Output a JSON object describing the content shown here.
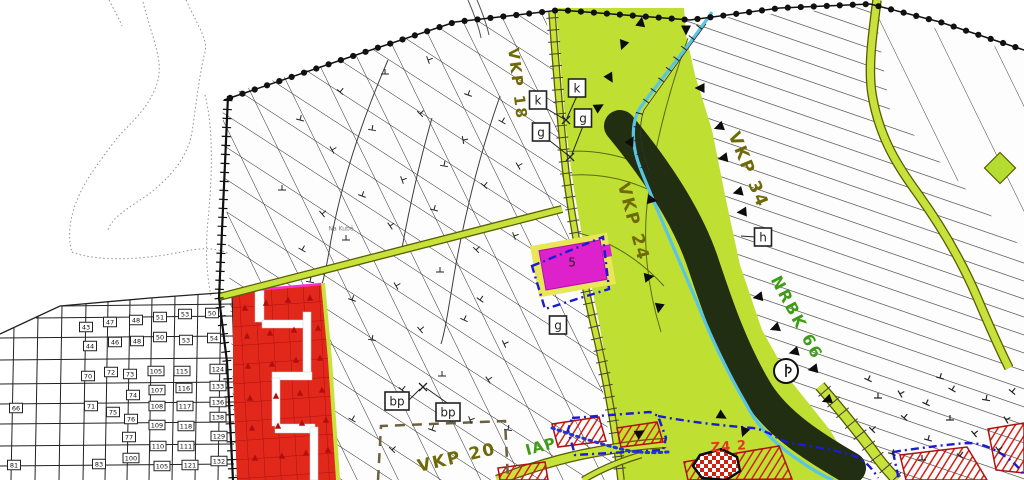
{
  "canvas": {
    "w": 1024,
    "h": 480
  },
  "palette": {
    "paper": "#ffffff",
    "hatch_dark": "#2f2f2f",
    "corridor_green": "#bfdf33",
    "forest_dark": "#212e12",
    "stream_blue": "#59c4e4",
    "road_fill": "#c7e23a",
    "road_edge": "#5c5c00",
    "red_zone": "#e2271b",
    "red_zone_line": "#aa1111",
    "red_hatch": "#d41f14",
    "magenta": "#dd22cc",
    "magenta_buffer": "#e9e659",
    "blue_boundary": "#1b1bd4",
    "olive_label": "#6f6a08",
    "green_label": "#3f9d15",
    "boundary_black": "#111111"
  },
  "regions": {
    "central_hatch": {
      "points": [
        [
          222,
          96
        ],
        [
          350,
          57
        ],
        [
          455,
          22
        ],
        [
          545,
          10
        ],
        [
          552,
          60
        ],
        [
          558,
          130
        ],
        [
          566,
          190
        ],
        [
          578,
          258
        ],
        [
          592,
          328
        ],
        [
          604,
          398
        ],
        [
          614,
          480
        ],
        [
          235,
          480
        ],
        [
          230,
          295
        ]
      ],
      "hatches": [
        {
          "angle": 33,
          "gap": 27,
          "color": "#2f2f2f",
          "w": 1
        },
        {
          "angle": 64,
          "gap": 37,
          "color": "#2f2f2f",
          "w": 1
        }
      ]
    },
    "right_hatch": {
      "points": [
        [
          685,
          8
        ],
        [
          695,
          75
        ],
        [
          712,
          130
        ],
        [
          726,
          200
        ],
        [
          740,
          265
        ],
        [
          762,
          330
        ],
        [
          790,
          380
        ],
        [
          830,
          430
        ],
        [
          860,
          480
        ],
        [
          1024,
          480
        ],
        [
          1024,
          52
        ],
        [
          885,
          5
        ],
        [
          800,
          12
        ],
        [
          690,
          20
        ]
      ],
      "hatches": [
        {
          "angle": 19,
          "gap": 17,
          "color": "#383838",
          "w": 1.2
        }
      ]
    },
    "topright_cross": {
      "points": [
        [
          875,
          10
        ],
        [
          1024,
          55
        ],
        [
          1024,
          250
        ],
        [
          890,
          110
        ]
      ],
      "hatches": [
        {
          "angle": 64,
          "gap": 46,
          "color": "#444444",
          "w": 1
        }
      ]
    },
    "green_corridor": {
      "points": [
        [
          556,
          8
        ],
        [
          560,
          60
        ],
        [
          566,
          130
        ],
        [
          574,
          190
        ],
        [
          586,
          258
        ],
        [
          600,
          328
        ],
        [
          612,
          398
        ],
        [
          622,
          480
        ],
        [
          860,
          480
        ],
        [
          830,
          430
        ],
        [
          790,
          380
        ],
        [
          762,
          330
        ],
        [
          740,
          265
        ],
        [
          726,
          200
        ],
        [
          712,
          130
        ],
        [
          695,
          75
        ],
        [
          686,
          35
        ],
        [
          684,
          8
        ]
      ]
    }
  },
  "forest": {
    "d": "M620,126 C658,172 688,218 703,263 C718,308 733,352 758,393 C778,424 812,446 850,468",
    "width": 32
  },
  "stream": {
    "d": "M712,12 C692,42 662,78 640,108 C630,124 632,148 641,170 C656,208 676,253 696,300 C710,335 726,370 746,404 C757,426 776,445 800,461 C813,470 823,476 833,480",
    "width": 3.2
  },
  "roads": [
    {
      "d": "M219,297 L562,209",
      "w": 5.5
    },
    {
      "d": "M552,12 C556,68 560,118 566,173 C574,233 586,293 598,343 C608,389 616,434 621,480",
      "w": 5,
      "ticks": 12
    },
    {
      "d": "M877,0 C872,38 868,68 872,94 C879,138 899,168 918,194 C941,226 962,262 977,297 C991,330 1001,352 1009,368",
      "w": 7
    },
    {
      "d": "M820,386 C844,414 864,439 877,457 C886,469 892,475 897,480",
      "w": 9,
      "ticks": 14
    },
    {
      "d": "M497,480 C530,468 561,458 595,452 C621,447 646,444 666,443",
      "w": 8
    },
    {
      "d": "M583,480 C601,469 621,461 641,455",
      "w": 4.5
    }
  ],
  "boundary_dots": {
    "points": [
      [
        224,
        100
      ],
      [
        350,
        57
      ],
      [
        455,
        22
      ],
      [
        560,
        10
      ],
      [
        690,
        20
      ],
      [
        780,
        8
      ],
      [
        870,
        4
      ],
      [
        940,
        22
      ],
      [
        1024,
        50
      ]
    ],
    "r": 3.1,
    "step": 13
  },
  "ladder": {
    "points": [
      [
        228,
        96
      ],
      [
        219,
        298
      ],
      [
        227,
        362
      ],
      [
        233,
        480
      ]
    ],
    "step": 9,
    "tick": 9
  },
  "field_path": [
    "M468,0 C474,14 479,27 481,38",
    "M477,0 C483,14 487,26 489,35"
  ],
  "contours_faint": [
    "M143,2 C152,38 163,58 158,80 C150,110 126,126 114,142 C99,162 84,182 78,198 C70,216 67,236 72,252",
    "M186,0 C199,28 208,40 205,52 C199,76 196,106 192,132 C187,162 164,182 149,194 C130,207 112,217 108,230",
    "M109,0 C114,10 119,18 122,26",
    "M72,252 C100,263 150,259 186,251 C210,246 225,250 233,257",
    "M205,95 C214,130 212,180 208,220 C205,252 207,276 211,296"
  ],
  "contours_dark": [
    "M388,60 C362,120 342,180 331,240 C324,284 318,300 312,308",
    "M500,96 C481,150 466,210 456,264 C449,304 446,328 441,344",
    "M432,118 C420,160 410,205 402,248"
  ],
  "corridor_lines": [
    "M688,38 C670,88 656,140 649,190 C641,240 648,290 661,332",
    "M560,152 C600,148 638,158 676,182",
    "M562,176 C610,170 650,186 688,212",
    "M574,232 C610,240 640,260 664,286"
  ],
  "fence_line": {
    "d": "M706,24 C688,48 664,82 644,110 C638,126 640,148 649,170",
    "step": 13,
    "tick": 7
  },
  "grid": {
    "cols": [
      14,
      38,
      62,
      86,
      108,
      130,
      152,
      175,
      198,
      221
    ],
    "rows": [
      306,
      318,
      338,
      360,
      384,
      404,
      424,
      446,
      466
    ],
    "top": [
      [
        0,
        334
      ],
      [
        60,
        306
      ],
      [
        150,
        298
      ],
      [
        232,
        292
      ]
    ],
    "right": [
      [
        232,
        292
      ],
      [
        238,
        480
      ]
    ]
  },
  "parcel_numbers": [
    {
      "n": "43",
      "x": 86,
      "y": 327
    },
    {
      "n": "47",
      "x": 110,
      "y": 322
    },
    {
      "n": "48",
      "x": 136,
      "y": 320
    },
    {
      "n": "51",
      "x": 160,
      "y": 317
    },
    {
      "n": "53",
      "x": 185,
      "y": 314
    },
    {
      "n": "50",
      "x": 212,
      "y": 313
    },
    {
      "n": "44",
      "x": 90,
      "y": 346
    },
    {
      "n": "46",
      "x": 115,
      "y": 342
    },
    {
      "n": "48",
      "x": 137,
      "y": 341
    },
    {
      "n": "50",
      "x": 160,
      "y": 337
    },
    {
      "n": "53",
      "x": 186,
      "y": 340
    },
    {
      "n": "54",
      "x": 214,
      "y": 338
    },
    {
      "n": "70",
      "x": 88,
      "y": 376
    },
    {
      "n": "72",
      "x": 111,
      "y": 372
    },
    {
      "n": "73",
      "x": 130,
      "y": 374
    },
    {
      "n": "105",
      "x": 156,
      "y": 371
    },
    {
      "n": "115",
      "x": 182,
      "y": 371
    },
    {
      "n": "124",
      "x": 218,
      "y": 369
    },
    {
      "n": "71",
      "x": 91,
      "y": 406
    },
    {
      "n": "74",
      "x": 133,
      "y": 395
    },
    {
      "n": "107",
      "x": 157,
      "y": 390
    },
    {
      "n": "116",
      "x": 184,
      "y": 388
    },
    {
      "n": "133",
      "x": 218,
      "y": 386
    },
    {
      "n": "75",
      "x": 113,
      "y": 412
    },
    {
      "n": "76",
      "x": 131,
      "y": 419
    },
    {
      "n": "108",
      "x": 157,
      "y": 406
    },
    {
      "n": "117",
      "x": 185,
      "y": 406
    },
    {
      "n": "136",
      "x": 218,
      "y": 402
    },
    {
      "n": "77",
      "x": 129,
      "y": 437
    },
    {
      "n": "109",
      "x": 157,
      "y": 425
    },
    {
      "n": "118",
      "x": 186,
      "y": 426
    },
    {
      "n": "138",
      "x": 218,
      "y": 417
    },
    {
      "n": "110",
      "x": 158,
      "y": 446
    },
    {
      "n": "111",
      "x": 186,
      "y": 446
    },
    {
      "n": "129",
      "x": 219,
      "y": 436
    },
    {
      "n": "83",
      "x": 99,
      "y": 464
    },
    {
      "n": "100",
      "x": 131,
      "y": 458
    },
    {
      "n": "105",
      "x": 162,
      "y": 466
    },
    {
      "n": "121",
      "x": 190,
      "y": 465
    },
    {
      "n": "132",
      "x": 219,
      "y": 461
    },
    {
      "n": "66",
      "x": 16,
      "y": 408
    },
    {
      "n": "81",
      "x": 14,
      "y": 465
    }
  ],
  "red_zone": {
    "points": [
      [
        233,
        291
      ],
      [
        322,
        283
      ],
      [
        330,
        360
      ],
      [
        337,
        480
      ],
      [
        237,
        480
      ],
      [
        233,
        380
      ]
    ],
    "streets": [
      [
        255,
        288,
        9,
        34
      ],
      [
        262,
        320,
        46,
        8
      ],
      [
        303,
        312,
        8,
        62
      ],
      [
        272,
        372,
        40,
        8
      ],
      [
        272,
        378,
        8,
        48
      ],
      [
        275,
        424,
        40,
        9
      ],
      [
        310,
        427,
        8,
        53
      ]
    ],
    "triangles": [
      [
        245,
        308
      ],
      [
        266,
        303
      ],
      [
        288,
        300
      ],
      [
        310,
        298
      ],
      [
        247,
        336
      ],
      [
        270,
        333
      ],
      [
        294,
        330
      ],
      [
        318,
        328
      ],
      [
        248,
        366
      ],
      [
        272,
        364
      ],
      [
        296,
        360
      ],
      [
        320,
        358
      ],
      [
        250,
        398
      ],
      [
        276,
        396
      ],
      [
        300,
        393
      ],
      [
        322,
        390
      ],
      [
        252,
        428
      ],
      [
        278,
        426
      ],
      [
        302,
        423
      ],
      [
        326,
        420
      ],
      [
        255,
        458
      ],
      [
        282,
        456
      ],
      [
        306,
        453
      ],
      [
        328,
        450
      ]
    ],
    "pink_edge": "M231,292 L322,284",
    "lime_edge": "M323,283 L330,360 L338,480"
  },
  "red_hatch_shapes": [
    [
      [
        552,
        424
      ],
      [
        599,
        417
      ],
      [
        606,
        441
      ],
      [
        558,
        447
      ]
    ],
    [
      [
        617,
        428
      ],
      [
        657,
        422
      ],
      [
        663,
        442
      ],
      [
        621,
        447
      ]
    ],
    [
      [
        684,
        462
      ],
      [
        779,
        446
      ],
      [
        792,
        479
      ],
      [
        688,
        480
      ]
    ],
    [
      [
        900,
        455
      ],
      [
        967,
        447
      ],
      [
        987,
        480
      ],
      [
        906,
        480
      ]
    ],
    [
      [
        988,
        429
      ],
      [
        1024,
        423
      ],
      [
        1024,
        473
      ],
      [
        996,
        470
      ]
    ],
    [
      [
        498,
        468
      ],
      [
        545,
        462
      ],
      [
        548,
        480
      ],
      [
        500,
        480
      ]
    ]
  ],
  "checker_blob": [
    [
      700,
      455
    ],
    [
      722,
      449
    ],
    [
      737,
      457
    ],
    [
      740,
      471
    ],
    [
      726,
      480
    ],
    [
      702,
      478
    ],
    [
      693,
      466
    ]
  ],
  "magenta_parcel": {
    "cx": 573,
    "cy": 265,
    "rot": -10,
    "outer": [
      78,
      52
    ],
    "inner": [
      62,
      40
    ],
    "label": "5"
  },
  "blue_dashdot": [
    "M532,266 L603,237 L609,289 L545,309 Z",
    "M572,418 L650,412 L658,416 L666,438 L663,450 L575,455 L568,430 Z",
    "M658,416 C700,424 740,427 753,428 C770,431 778,440 790,443 C810,446 835,450 852,455 C865,460 872,468 878,478",
    "M893,452 C920,448 950,444 968,443 C985,443 1000,452 1010,460 C1018,466 1022,472 1024,476",
    "M893,452 L899,480"
  ],
  "blue_dotted": "M552,428 C575,436 600,444 625,450 C640,453 655,453 668,452",
  "vkp20_rect": "M378,480 L381,426 L505,421 L508,480",
  "green_diamond": {
    "x": 1000,
    "y": 168,
    "s": 22
  },
  "circle_symbol": {
    "x": 786,
    "y": 371,
    "r": 12
  },
  "labels": [
    {
      "id": "vkp-18",
      "text": "VKP 18",
      "x": 517,
      "y": 84,
      "rot": 83,
      "size": 15,
      "color": "#6f6a08",
      "ls": 2,
      "bold": true
    },
    {
      "id": "vkp-24",
      "text": "VKP 24",
      "x": 633,
      "y": 222,
      "rot": 75,
      "size": 17,
      "color": "#6f6a08",
      "ls": 2,
      "bold": true
    },
    {
      "id": "vkp-34",
      "text": "VKP 34",
      "x": 748,
      "y": 170,
      "rot": 68,
      "size": 17,
      "color": "#6f6a08",
      "ls": 2,
      "bold": true
    },
    {
      "id": "nrbk-66",
      "text": "NRBK 66",
      "x": 796,
      "y": 318,
      "rot": 62,
      "size": 16,
      "color": "#3f9d15",
      "ls": 2,
      "bold": true
    },
    {
      "id": "vkp-20",
      "text": "VKP 20",
      "x": 457,
      "y": 458,
      "rot": -13,
      "size": 17,
      "color": "#6f6a08",
      "ls": 2,
      "bold": true
    },
    {
      "id": "iap",
      "text": "IAP",
      "x": 541,
      "y": 447,
      "rot": -15,
      "size": 15,
      "color": "#3f9d15",
      "ls": 1,
      "bold": true
    },
    {
      "id": "z4-2",
      "text": "Z4 2",
      "x": 729,
      "y": 447,
      "rot": -4,
      "size": 13,
      "color": "#e83522",
      "ls": 1,
      "bold": true
    },
    {
      "id": "parcel-5",
      "text": "5",
      "x": 572,
      "y": 263,
      "rot": 0,
      "size": 12,
      "color": "#222222",
      "ls": 0,
      "bold": false
    },
    {
      "id": "na-kube",
      "text": "Na Kubě",
      "x": 341,
      "y": 229,
      "rot": 0,
      "size": 6,
      "color": "#777777",
      "ls": 0,
      "bold": false
    }
  ],
  "boxed_labels": [
    {
      "t": "k",
      "x": 577,
      "y": 88
    },
    {
      "t": "k",
      "x": 538,
      "y": 100
    },
    {
      "t": "g",
      "x": 583,
      "y": 118
    },
    {
      "t": "g",
      "x": 541,
      "y": 132
    },
    {
      "t": "g",
      "x": 558,
      "y": 325
    },
    {
      "t": "h",
      "x": 763,
      "y": 237
    },
    {
      "t": "bp",
      "x": 397,
      "y": 401
    },
    {
      "t": "bp",
      "x": 448,
      "y": 412
    }
  ],
  "leader_lines": [
    [
      577,
      96,
      567,
      118
    ],
    [
      542,
      106,
      564,
      119
    ],
    [
      583,
      126,
      572,
      154
    ],
    [
      545,
      137,
      569,
      156
    ],
    [
      403,
      406,
      420,
      389
    ],
    [
      450,
      405,
      426,
      388
    ],
    [
      755,
      237,
      741,
      236
    ]
  ],
  "x_marks": [
    [
      566,
      120
    ],
    [
      570,
      157
    ],
    [
      423,
      387
    ]
  ],
  "triangles": [
    [
      641,
      22,
      10
    ],
    [
      623,
      45,
      200
    ],
    [
      610,
      78,
      150
    ],
    [
      599,
      107,
      60
    ],
    [
      631,
      141,
      30
    ],
    [
      652,
      200,
      100
    ],
    [
      649,
      277,
      80
    ],
    [
      659,
      308,
      190
    ],
    [
      700,
      88,
      270
    ],
    [
      719,
      127,
      250
    ],
    [
      723,
      158,
      260
    ],
    [
      738,
      192,
      255
    ],
    [
      742,
      212,
      265
    ],
    [
      758,
      297,
      260
    ],
    [
      775,
      328,
      250
    ],
    [
      794,
      352,
      255
    ],
    [
      813,
      369,
      260
    ],
    [
      827,
      400,
      250
    ],
    [
      722,
      416,
      120
    ],
    [
      744,
      432,
      200
    ],
    [
      640,
      433,
      60
    ],
    [
      686,
      30,
      180
    ]
  ],
  "symbols_central": [
    [
      300,
      120,
      15
    ],
    [
      340,
      92,
      40
    ],
    [
      385,
      74,
      0
    ],
    [
      428,
      60,
      70
    ],
    [
      468,
      95,
      20
    ],
    [
      332,
      150,
      60
    ],
    [
      372,
      130,
      10
    ],
    [
      420,
      114,
      45
    ],
    [
      463,
      140,
      80
    ],
    [
      502,
      122,
      30
    ],
    [
      282,
      190,
      0
    ],
    [
      322,
      214,
      50
    ],
    [
      362,
      196,
      20
    ],
    [
      402,
      180,
      70
    ],
    [
      444,
      166,
      10
    ],
    [
      484,
      186,
      40
    ],
    [
      518,
      166,
      60
    ],
    [
      302,
      250,
      30
    ],
    [
      346,
      240,
      0
    ],
    [
      390,
      226,
      55
    ],
    [
      434,
      210,
      15
    ],
    [
      476,
      250,
      45
    ],
    [
      514,
      236,
      70
    ],
    [
      352,
      300,
      20
    ],
    [
      396,
      286,
      60
    ],
    [
      440,
      272,
      0
    ],
    [
      480,
      300,
      35
    ],
    [
      372,
      340,
      10
    ],
    [
      420,
      330,
      50
    ],
    [
      464,
      320,
      25
    ],
    [
      504,
      344,
      65
    ],
    [
      402,
      390,
      40
    ],
    [
      442,
      376,
      0
    ],
    [
      488,
      380,
      55
    ],
    [
      432,
      430,
      20
    ],
    [
      470,
      420,
      70
    ],
    [
      508,
      430,
      10
    ],
    [
      392,
      450,
      45
    ],
    [
      352,
      420,
      30
    ],
    [
      310,
      282,
      10
    ]
  ],
  "symbols_right": [
    [
      878,
      398,
      0
    ],
    [
      904,
      418,
      40
    ],
    [
      928,
      440,
      15
    ],
    [
      900,
      394,
      60
    ],
    [
      926,
      404,
      25
    ],
    [
      950,
      420,
      0
    ],
    [
      974,
      434,
      50
    ],
    [
      952,
      390,
      30
    ],
    [
      986,
      400,
      10
    ],
    [
      1006,
      420,
      60
    ],
    [
      872,
      430,
      45
    ],
    [
      892,
      454,
      20
    ],
    [
      922,
      460,
      0
    ],
    [
      960,
      456,
      35
    ],
    [
      998,
      450,
      55
    ],
    [
      940,
      378,
      15
    ],
    [
      1012,
      392,
      40
    ],
    [
      868,
      380,
      25
    ]
  ]
}
